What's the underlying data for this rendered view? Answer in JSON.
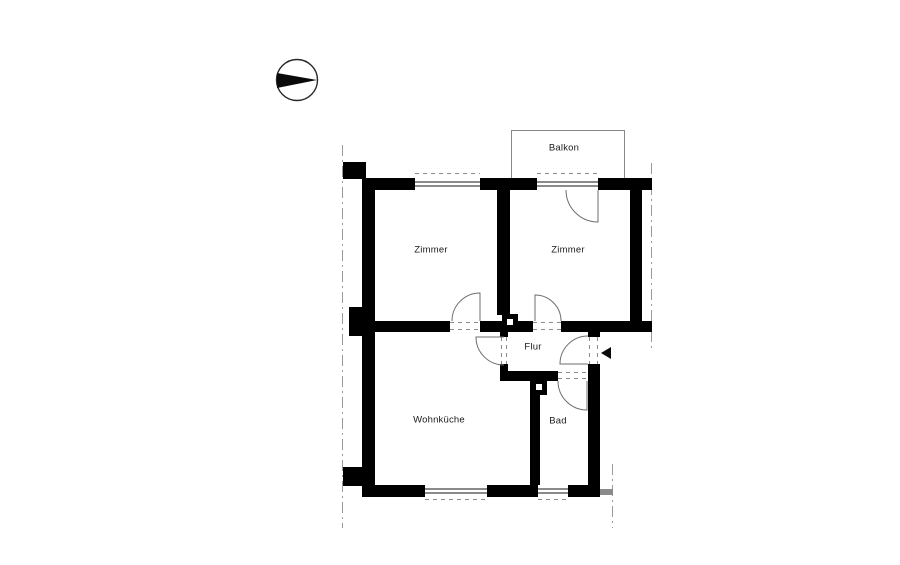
{
  "meta": {
    "type": "architectural-floor-plan",
    "background": "#ffffff"
  },
  "colors": {
    "wall": "#000000",
    "thin_outline": "#888888",
    "window_line": "#8a8a8a",
    "section_line": "#9a9a9a",
    "door_arc": "#6e6e6e",
    "text": "#1a1a1a",
    "arrow": "#0a0a0a"
  },
  "rooms": [
    {
      "id": "balkon",
      "label": "Balkon"
    },
    {
      "id": "zimmer-left",
      "label": "Zimmer"
    },
    {
      "id": "zimmer-right",
      "label": "Zimmer"
    },
    {
      "id": "flur",
      "label": "Flur"
    },
    {
      "id": "wohnkueche",
      "label": "Wohnküche"
    },
    {
      "id": "bad",
      "label": "Bad"
    }
  ],
  "icons": [
    {
      "name": "north-indicator-icon",
      "shape": "circle with solid triangle needle pointing right"
    },
    {
      "name": "entrance-arrow-icon",
      "shape": "solid triangle pointing left at entrance door"
    }
  ]
}
